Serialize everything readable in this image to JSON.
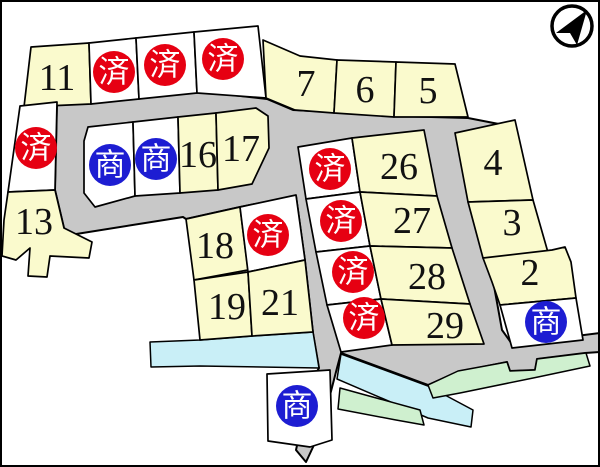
{
  "badges": {
    "sold": "済",
    "commercial": "商"
  },
  "lots": {
    "lot2": "2",
    "lot3": "3",
    "lot4": "4",
    "lot5": "5",
    "lot6": "6",
    "lot7": "7",
    "lot11": "11",
    "lot13": "13",
    "lot16": "16",
    "lot17": "17",
    "lot18": "18",
    "lot19": "19",
    "lot21": "21",
    "lot26": "26",
    "lot27": "27",
    "lot28": "28",
    "lot29": "29"
  },
  "colors": {
    "lot_fill": "#fafacd",
    "vacant_fill": "#ffffff",
    "road": "#c8c8c8",
    "river": "#c9eff7",
    "green_area": "#cff0cf",
    "sold_badge": "#e60012",
    "commercial_badge": "#1d1dd2",
    "outline": "#000000",
    "background": "#ffffff"
  }
}
